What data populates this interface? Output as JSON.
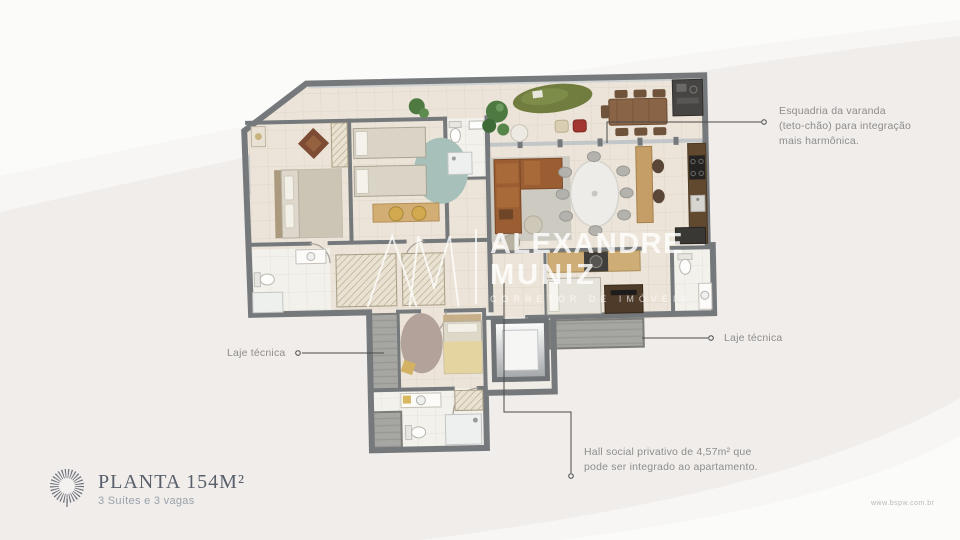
{
  "brand": {
    "title": "PLANTA 154M²",
    "subtitle": "3 Suítes e 3 vagas"
  },
  "watermark": {
    "name_line1": "ALEXANDRE",
    "name_line2": "MUNIZ",
    "tagline": "CORRETOR DE IMÓVEIS"
  },
  "annotations": {
    "esquadria": {
      "lines": [
        "Esquadria da varanda",
        "(teto-chão) para integração",
        "mais harmônica."
      ]
    },
    "laje_left": {
      "label": "Laje técnica"
    },
    "laje_right": {
      "label": "Laje técnica"
    },
    "hall": {
      "lines": [
        "Hall social privativo de 4,57m² que",
        "pode ser integrado ao apartamento."
      ]
    }
  },
  "footer": {
    "website": "www.bspw.com.br"
  },
  "colors": {
    "wall": "#75797c",
    "floor": "#ece4d8",
    "laje": "#a6a6a2",
    "accent_wood": "#c49e66",
    "annotation_text": "#8e8d8b",
    "title_text": "#59606a"
  }
}
